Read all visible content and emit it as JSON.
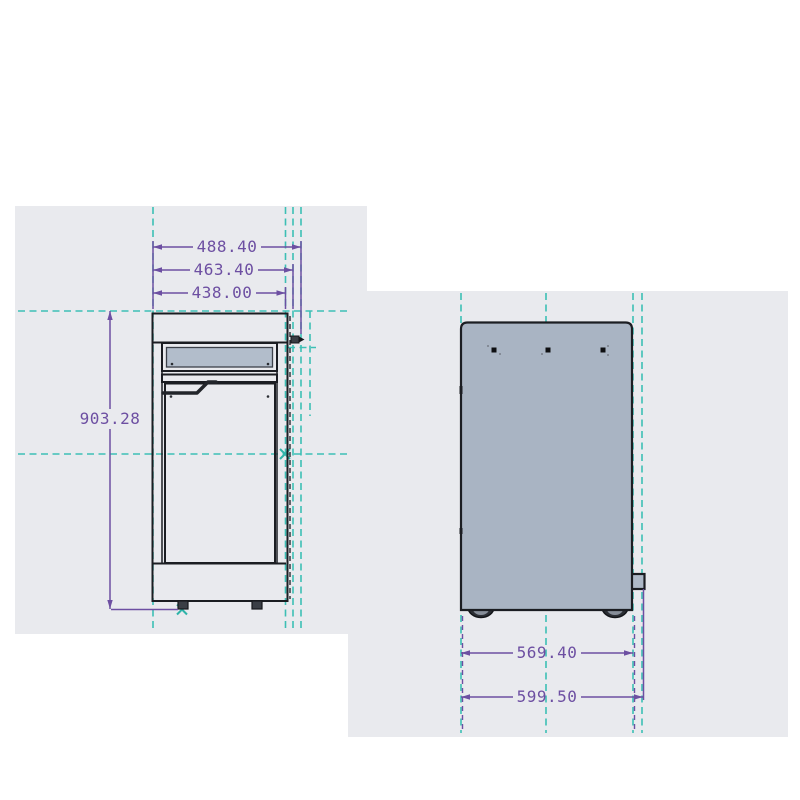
{
  "drawing": {
    "title": "appliance-two-view-dimension-drawing",
    "front_view": {
      "name": "front-view",
      "dim_width_overall": "488.40",
      "dim_width_body": "463.40",
      "dim_width_door": "438.00",
      "dim_height": "903.28"
    },
    "back_view": {
      "name": "back-view",
      "dim_width_wheelbase": "569.40",
      "dim_width_overall": "599.50"
    },
    "colors": {
      "construction_teal": "#3dbfb5",
      "dimension_purple": "#6d4fa2",
      "body_fill": "#a9b4c3",
      "door_fill": "#aeb9c8",
      "outline": "#1b1d22",
      "viewport_gray": "#e9eaee"
    }
  }
}
